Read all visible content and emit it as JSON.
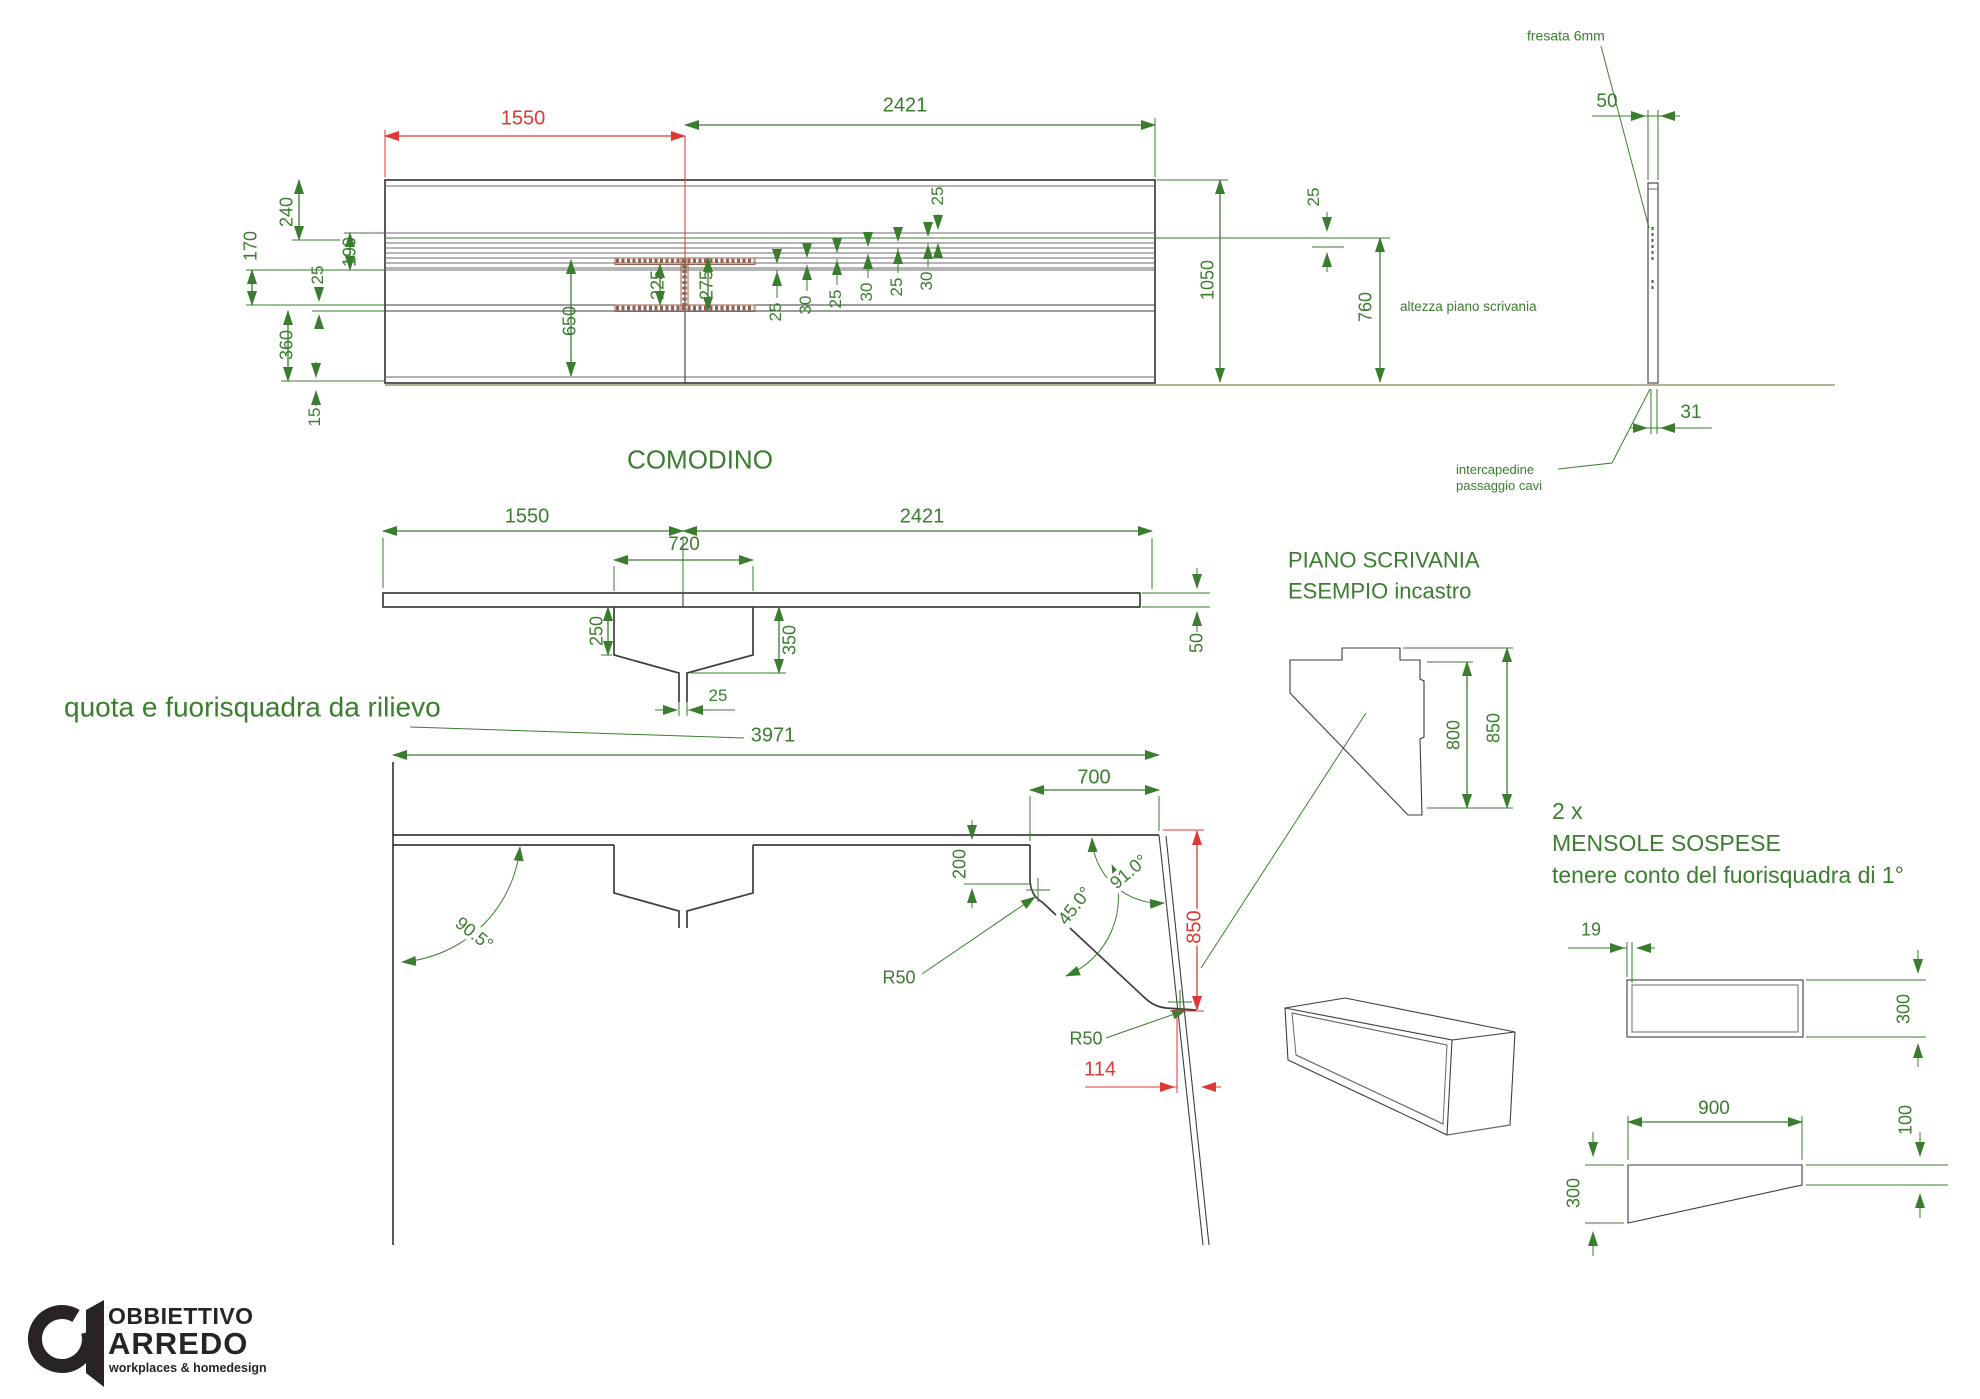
{
  "colors": {
    "green": "#3a7d2e",
    "red": "#dc3a33",
    "dark": "#3d3d3d",
    "mid": "#6a6a6a",
    "ground": "#9a9a72",
    "hatch": "#96604e",
    "logo": "#282425"
  },
  "logo": {
    "line1": "OBBIETTIVO",
    "line2": "ARREDO",
    "line3": "workplaces & homedesign"
  },
  "titles": {
    "elevation": "COMODINO",
    "detail1": "PIANO SCRIVANIA",
    "detail2": "ESEMPIO incastro"
  },
  "labels": [
    {
      "n": "dim-wall-1550",
      "t": "1550",
      "x": 523,
      "y": 119,
      "c": "red",
      "fs": 20
    },
    {
      "n": "dim-wall-2421",
      "t": "2421",
      "x": 905,
      "y": 106,
      "fs": 20
    },
    {
      "n": "dim-240",
      "t": "240",
      "x": 287,
      "y": 212,
      "r": -90,
      "fs": 18
    },
    {
      "n": "dim-170",
      "t": "170",
      "x": 251,
      "y": 246,
      "r": -90,
      "fs": 18
    },
    {
      "n": "dim-190",
      "t": "190",
      "x": 350,
      "y": 252,
      "r": -90,
      "fs": 18
    },
    {
      "n": "dim-25-left",
      "t": "25",
      "x": 318,
      "y": 275,
      "r": -90,
      "fs": 17
    },
    {
      "n": "dim-360",
      "t": "360",
      "x": 287,
      "y": 345,
      "r": -90,
      "fs": 18
    },
    {
      "n": "dim-15",
      "t": "15",
      "x": 315,
      "y": 417,
      "r": -90,
      "fs": 17
    },
    {
      "n": "dim-650",
      "t": "650",
      "x": 570,
      "y": 321,
      "r": -90,
      "fs": 18
    },
    {
      "n": "dim-225",
      "t": "225",
      "x": 658,
      "y": 285,
      "r": -90,
      "fs": 18
    },
    {
      "n": "dim-275",
      "t": "275",
      "x": 707,
      "y": 285,
      "r": -90,
      "fs": 18
    },
    {
      "n": "dim-groove1-25",
      "t": "25",
      "x": 776,
      "y": 312,
      "r": -90,
      "fs": 17
    },
    {
      "n": "dim-groove2-30",
      "t": "30",
      "x": 806,
      "y": 305,
      "r": -90,
      "fs": 17
    },
    {
      "n": "dim-groove3-25",
      "t": "25",
      "x": 836,
      "y": 299,
      "r": -90,
      "fs": 17
    },
    {
      "n": "dim-groove4-30",
      "t": "30",
      "x": 867,
      "y": 292,
      "r": -90,
      "fs": 17
    },
    {
      "n": "dim-groove5-25",
      "t": "25",
      "x": 897,
      "y": 287,
      "r": -90,
      "fs": 17
    },
    {
      "n": "dim-groove6-30",
      "t": "30",
      "x": 927,
      "y": 281,
      "r": -90,
      "fs": 17
    },
    {
      "n": "dim-25-mid-top",
      "t": "25",
      "x": 938,
      "y": 196,
      "r": -90,
      "fs": 17
    },
    {
      "n": "dim-1050",
      "t": "1050",
      "x": 1208,
      "y": 280,
      "r": -90,
      "fs": 18
    },
    {
      "n": "dim-25-right",
      "t": "25",
      "x": 1314,
      "y": 197,
      "r": -90,
      "fs": 17
    },
    {
      "n": "dim-760",
      "t": "760",
      "x": 1366,
      "y": 307,
      "r": -90,
      "fs": 18
    },
    {
      "n": "note-altezza",
      "t": "altezza piano scrivania",
      "x": 1400,
      "y": 307,
      "a": "l",
      "fs": 13.5
    },
    {
      "n": "title-comodino",
      "t": "COMODINO",
      "x": 700,
      "y": 460,
      "fs": 26
    },
    {
      "n": "note-fresata",
      "t": "fresata 6mm",
      "x": 1527,
      "y": 36,
      "a": "l",
      "fs": 14
    },
    {
      "n": "dim-50-fresata",
      "t": "50",
      "x": 1607,
      "y": 102,
      "fs": 19
    },
    {
      "n": "dim-31",
      "t": "31",
      "x": 1691,
      "y": 413,
      "fs": 19
    },
    {
      "n": "note-intercapedine",
      "t": "intercapedine",
      "x": 1456,
      "y": 470,
      "a": "l",
      "fs": 13
    },
    {
      "n": "note-passaggio-cavi",
      "t": "passaggio cavi",
      "x": 1456,
      "y": 486,
      "a": "l",
      "fs": 13
    },
    {
      "n": "dim-plan-1550",
      "t": "1550",
      "x": 527,
      "y": 517,
      "fs": 20
    },
    {
      "n": "dim-plan-2421",
      "t": "2421",
      "x": 922,
      "y": 517,
      "fs": 20
    },
    {
      "n": "dim-720",
      "t": "720",
      "x": 684,
      "y": 545,
      "fs": 19
    },
    {
      "n": "dim-250",
      "t": "250",
      "x": 597,
      "y": 631,
      "r": -90,
      "fs": 18
    },
    {
      "n": "dim-350",
      "t": "350",
      "x": 790,
      "y": 640,
      "r": -90,
      "fs": 18
    },
    {
      "n": "dim-25-notch",
      "t": "25",
      "x": 718,
      "y": 696,
      "fs": 17
    },
    {
      "n": "dim-50-plank",
      "t": "50",
      "x": 1197,
      "y": 643,
      "r": -90,
      "fs": 18
    },
    {
      "n": "note-quota",
      "t": "quota e fuorisquadra da rilievo",
      "x": 64,
      "y": 707,
      "a": "l",
      "fs": 28
    },
    {
      "n": "dim-3971",
      "t": "3971",
      "x": 773,
      "y": 736,
      "fs": 20
    },
    {
      "n": "dim-700",
      "t": "700",
      "x": 1094,
      "y": 778,
      "fs": 20
    },
    {
      "n": "dim-200",
      "t": "200",
      "x": 960,
      "y": 864,
      "r": -90,
      "fs": 18
    },
    {
      "n": "dim-angle-90-5",
      "t": "90.5°",
      "x": 474,
      "y": 934,
      "r": 38,
      "fs": 18,
      "bg": 1
    },
    {
      "n": "dim-angle-45-0",
      "t": "45.0°",
      "x": 1075,
      "y": 906,
      "r": -52,
      "fs": 18,
      "bg": 1
    },
    {
      "n": "dim-angle-91-0",
      "t": "91.0°",
      "x": 1129,
      "y": 872,
      "r": -40,
      "fs": 18,
      "bg": 1
    },
    {
      "n": "dim-r50-a",
      "t": "R50",
      "x": 899,
      "y": 978,
      "fs": 18
    },
    {
      "n": "dim-r50-b",
      "t": "R50",
      "x": 1086,
      "y": 1039,
      "fs": 18
    },
    {
      "n": "dim-850-red",
      "t": "850",
      "x": 1195,
      "y": 927,
      "r": -90,
      "c": "red",
      "fs": 20,
      "bg": 1
    },
    {
      "n": "dim-114-red",
      "t": "114",
      "x": 1100,
      "y": 1070,
      "c": "red",
      "fs": 20
    },
    {
      "n": "title-piano-scrivania",
      "t": "PIANO SCRIVANIA",
      "x": 1288,
      "y": 560,
      "a": "l",
      "fs": 22
    },
    {
      "n": "title-esempio-incastro",
      "t": "ESEMPIO incastro",
      "x": 1288,
      "y": 591,
      "a": "l",
      "fs": 22
    },
    {
      "n": "dim-800",
      "t": "800",
      "x": 1454,
      "y": 735,
      "r": -90,
      "fs": 18
    },
    {
      "n": "dim-850-detail",
      "t": "850",
      "x": 1494,
      "y": 728,
      "r": -90,
      "fs": 18
    },
    {
      "n": "note-2x",
      "t": "2 x",
      "x": 1552,
      "y": 811,
      "a": "l",
      "fs": 23
    },
    {
      "n": "note-mensole-sospese",
      "t": "MENSOLE SOSPESE",
      "x": 1552,
      "y": 843,
      "a": "l",
      "fs": 23
    },
    {
      "n": "note-fuorisquadra",
      "t": "tenere conto del fuorisquadra di 1°",
      "x": 1552,
      "y": 875,
      "a": "l",
      "fs": 23
    },
    {
      "n": "dim-19",
      "t": "19",
      "x": 1591,
      "y": 930,
      "fs": 18
    },
    {
      "n": "dim-300-front",
      "t": "300",
      "x": 1904,
      "y": 1009,
      "r": -90,
      "fs": 18
    },
    {
      "n": "dim-900",
      "t": "900",
      "x": 1714,
      "y": 1109,
      "fs": 19
    },
    {
      "n": "dim-100",
      "t": "100",
      "x": 1906,
      "y": 1120,
      "r": -90,
      "fs": 18
    },
    {
      "n": "dim-300-side",
      "t": "300",
      "x": 1574,
      "y": 1193,
      "r": -90,
      "fs": 18
    }
  ]
}
